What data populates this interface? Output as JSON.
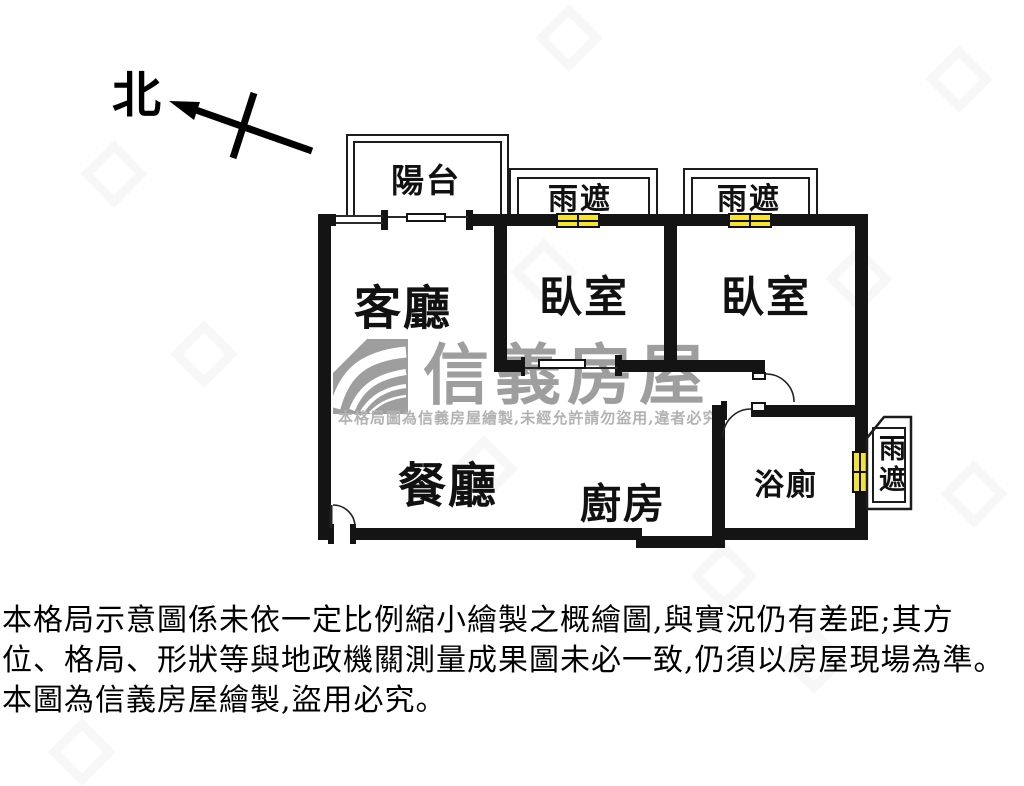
{
  "north": {
    "label": "北"
  },
  "plan": {
    "balcony": "陽台",
    "canopy_left": "雨遮",
    "canopy_right": "雨遮",
    "canopy_side": "雨遮",
    "living_room": "客廳",
    "bedroom_1": "臥室",
    "bedroom_2": "臥室",
    "dining_room": "餐廳",
    "kitchen": "廚房",
    "bathroom": "浴廁"
  },
  "watermark": {
    "brand": "信義房屋",
    "notice": "本格局圖為信義房屋繪製,未經允許請勿盜用,違者必究"
  },
  "disclaimer": {
    "line1": "本格局示意圖係未依一定比例縮小繪製之概繪圖,與實況仍有差距;其方",
    "line2": "位、格局、形狀等與地政機關測量成果圖未必一致,仍須以房屋現場為準。",
    "line3": "本圖為信義房屋繪製,盜用必究。"
  },
  "colors": {
    "wall": "#141414",
    "window_fill": "#f3e23c",
    "watermark_gray": "#9e9e9e"
  }
}
